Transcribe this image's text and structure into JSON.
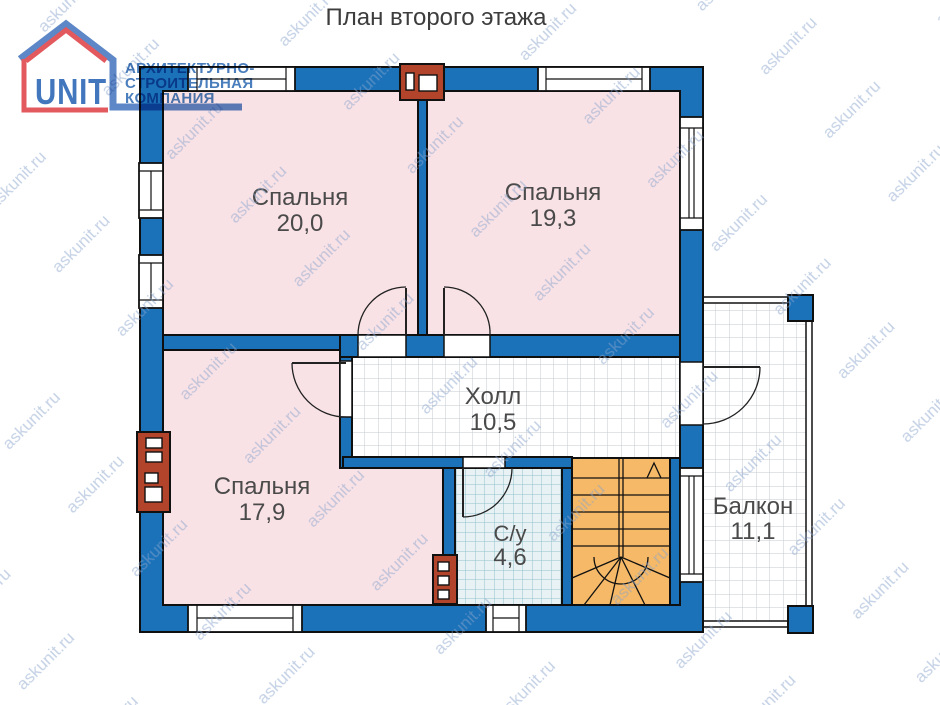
{
  "title": "План второго этажа",
  "logo": {
    "brand": "UNIT",
    "line1": "АРХИТЕКТУРНО-",
    "line2": "СТРОИТЕЛЬНАЯ",
    "line3": "КОМПАНИЯ"
  },
  "watermark": {
    "text": "askunit.ru"
  },
  "rooms": [
    {
      "id": "bedroom-1",
      "name": "Спальня",
      "area": "20,0"
    },
    {
      "id": "bedroom-2",
      "name": "Спальня",
      "area": "19,3"
    },
    {
      "id": "bedroom-3",
      "name": "Спальня",
      "area": "17,9"
    },
    {
      "id": "hall",
      "name": "Холл",
      "area": "10,5"
    },
    {
      "id": "bathroom",
      "name": "С/у",
      "area": "4,6"
    },
    {
      "id": "balcony",
      "name": "Балкон",
      "area": "11,1"
    }
  ],
  "colors": {
    "wall": "#1b72b9",
    "room_fill": "#f9e2e6",
    "stairs": "#f5b967",
    "chimney": "#b2442c",
    "bath_tile_bg": "#e8f2f4",
    "bath_tile_line": "#93c3ce",
    "floor_tile_line": "#c6cbd0",
    "logo_blue": "#5d87c6",
    "logo_red": "#e2595e",
    "logo_text": "#4377bd",
    "label_gray": "#4a4a4a"
  }
}
